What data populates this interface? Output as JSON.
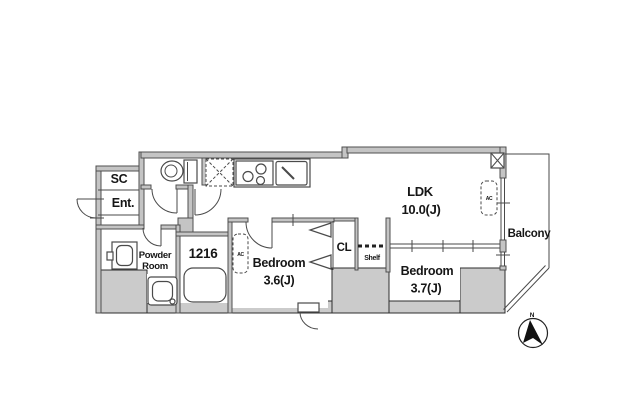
{
  "rooms": {
    "shoe_closet": {
      "label": "SC"
    },
    "entrance": {
      "label": "Ent."
    },
    "powder_room": {
      "line1": "Powder",
      "line2": "Room"
    },
    "bathroom": {
      "label": "1216"
    },
    "ldk": {
      "name": "LDK",
      "size": "10.0(J)"
    },
    "bedroom_1": {
      "name": "Bedroom",
      "size": "3.6(J)"
    },
    "bedroom_2": {
      "name": "Bedroom",
      "size": "3.7(J)"
    },
    "closet": {
      "label": "CL"
    },
    "shelf": {
      "label": "Shelf"
    },
    "balcony": {
      "label": "Balcony"
    }
  },
  "equipment": {
    "ac": "AC"
  },
  "compass": {
    "north": "N"
  },
  "colors": {
    "background": "#ffffff",
    "wall_fill": "#c4c4c4",
    "wall_edge": "#4f4f4f",
    "shaded_block_fill": "#cbcbcb",
    "shaded_block_edge": "#2e2e2e",
    "line": "#4a4a4a",
    "text": "#161616"
  },
  "icons": [
    "toilet-icon",
    "stove-icon",
    "sink-icon",
    "refrigerator-space-icon",
    "pipe-space-icon",
    "washbasin-icon",
    "washing-machine-icon",
    "bathtub-icon",
    "ac-unit-icon",
    "door-swing-icon",
    "bifold-door-icon",
    "north-arrow-icon"
  ]
}
